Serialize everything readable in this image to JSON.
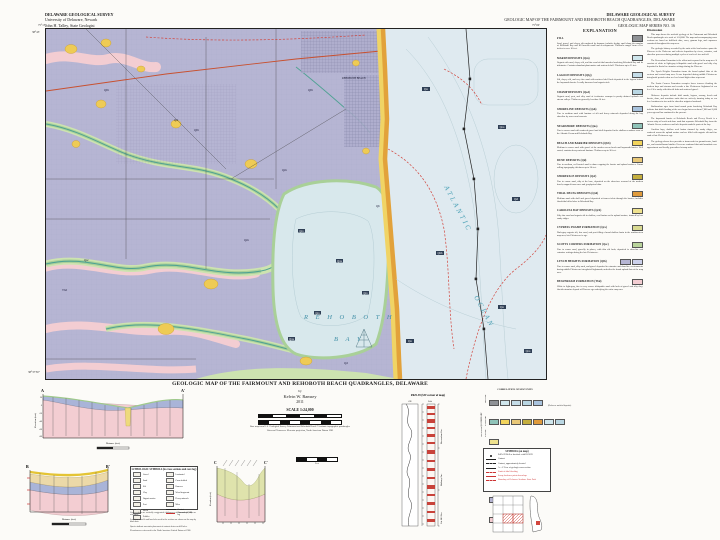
{
  "header_left": {
    "line1": "DELAWARE GEOLOGICAL SURVEY",
    "line2": "University of Delaware, Newark",
    "line3": "John H. Talley, State Geologist"
  },
  "header_right": {
    "line1": "DELAWARE GEOLOGICAL SURVEY",
    "line2": "GEOLOGIC MAP OF THE FAIRMOUNT AND REHOBOTH BEACH QUADRANGLES, DELAWARE",
    "line3": "GEOLOGIC MAP SERIES NO. 16"
  },
  "map": {
    "corner_tl": "75°15'",
    "corner_tr": "75°00'",
    "corner_lat_top": "38°45'",
    "corner_lat_bot": "38°37'30\"",
    "labels": {
      "bay1": "R E H O B O T H",
      "bay2": "B A Y",
      "ocean1": "ATLANTIC",
      "ocean2": "OCEAN",
      "town": "REHOBOTH BEACH"
    },
    "units": [
      {
        "t": "Qlh"
      },
      {
        "t": "Qlh"
      },
      {
        "t": "Qd"
      },
      {
        "t": "Qsc"
      },
      {
        "t": "Tbd"
      },
      {
        "t": "Qm"
      },
      {
        "t": "Qlh"
      },
      {
        "t": "Qb"
      },
      {
        "t": "Qd"
      },
      {
        "t": "Qm"
      }
    ],
    "samples": [
      "Qm",
      "Qns",
      "Qsf",
      "Qbb",
      "Qm",
      "Qns",
      "Qm",
      "Qm",
      "Qns",
      "Qm",
      "Qm",
      "Qns"
    ]
  },
  "legend": {
    "title": "EXPLANATION",
    "entries": [
      {
        "heading": "FILL",
        "chips": [
          "#8f9296"
        ],
        "text": "Sand, gravel, and clayey silt emplaced by humans; includes dredge spoil along the margins of Rehoboth Bay and fill beneath roads and developments. Thickness ranges from a few inches to over 10 feet."
      },
      {
        "heading": "MARSH DEPOSITS (Qm)",
        "chips": [
          "#cfe6ec"
        ],
        "text": "Organic-rich mud, clayey silt, and fine sand of tidal marshes bordering Rehoboth Bay and its tributaries. Contains abundant plant matter and scattered shell. Thickness up to 25 feet."
      },
      {
        "heading": "LAGOON DEPOSITS (Qlg)",
        "chips": [
          "#c5dde8"
        ],
        "text": "Silt, clayey silt, and very fine sand with scattered shell beds deposited in the lagoon behind the baymouth barrier. Locally burrowed and organic-rich."
      },
      {
        "heading": "SWAMP DEPOSITS (Qsd)",
        "chips": [
          "#b9d6e2"
        ],
        "text": "Organic mud, peat, and silty sand of freshwater swamps in poorly drained uplands and stream valleys. Thickness generally less than 10 feet."
      },
      {
        "heading": "SHORELINE DEPOSITS (Qsh)",
        "chips": [
          "#a9c3dd"
        ],
        "text": "Fine to medium sand with laminae of silt and heavy minerals deposited along the bay shoreline by waves and currents."
      },
      {
        "heading": "NEARSHORE DEPOSITS (Qns)",
        "chips": [
          "#8fc3b8"
        ],
        "text": "Fine to coarse sand with scattered gravel and shell deposited in the shallow nearshore zone of the Atlantic Ocean and Rehoboth Bay."
      },
      {
        "heading": "BEACH AND BARRIER DEPOSITS (Qbb)",
        "chips": [
          "#f2d45c"
        ],
        "text": "Medium to coarse sand with gravel of the modern ocean beach and baymouth barrier. Well sorted; contains heavy-mineral laminae. Thickness up to 30 feet."
      },
      {
        "heading": "DUNE DEPOSITS (Qd)",
        "chips": [
          "#e9c878"
        ],
        "text": "Fine to medium, well-sorted sand in dunes capping the barrier and upland surfaces. Forms rolling topography; thickness up to 20 feet."
      },
      {
        "heading": "SHOREFACE DEPOSITS (Qsf)",
        "chips": [
          "#c4ae3e"
        ],
        "text": "Fine to coarse sand, silty at the base, deposited on the shoreface seaward of the modern beach; mapped from cores and geophysical data."
      },
      {
        "heading": "TIDAL DELTA DEPOSITS (Qtd)",
        "chips": [
          "#e09b3c"
        ],
        "text": "Medium sand with shell and gravel deposited at former inlets through the barrier; includes flood-tidal delta lobes in Rehoboth Bay."
      },
      {
        "heading": "CAROLINA BAY DEPOSITS (Qcb)",
        "chips": [
          "#efe28e"
        ],
        "text": "Silty fine sand and organic silt in shallow, oval basins on the upland surface; rimmed by low sandy ridges."
      },
      {
        "heading": "CYPRESS SWAMP FORMATION (Qcs)",
        "chips": [
          "#d9da92"
        ],
        "text": "Dark-gray organic silt, fine sand, and peat filling a broad shallow basin in the southwestern map area; late Pleistocene in age."
      },
      {
        "heading": "SCOTTS CORNERS FORMATION (Qsc)",
        "chips": [
          "#b9d49b"
        ],
        "text": "Fine to coarse sand, gravelly in places, with thin silt beds; deposited in shoreline and estuarine settings during the late Pleistocene."
      },
      {
        "heading": "LYNCH HEIGHTS FORMATION (Qlh)",
        "chips": [
          "#b6b5d3",
          "#ccd0ea"
        ],
        "text": "Fine to coarse sand, silty sand, and gravel deposited in estuarine and shoreline environments during middle Pleistocene interglacial highstands; underlies the broad upland flats of the map area."
      },
      {
        "heading": "BEAVERDAM FORMATION (Tbd)",
        "chips": [
          "#f3cdd2"
        ],
        "text": "White to light-gray, fine to very coarse feldspathic sand with beds of gravel and silty clay; fluvial-estuarine deposit of Pliocene age underlying the entire map area."
      }
    ]
  },
  "discussion": {
    "title": "Discussion",
    "paragraphs": [
      "This map shows the surficial geology of the Fairmount and Rehoboth Beach quadrangles at a scale of 1:24,000. The map and accompanying cross sections are based on drill-hole data, cores, gamma logs, and exposures examined throughout the map area.",
      "The geologic history recorded by the units at the land surface spans the Pliocene to the Holocene and reflects deposition by rivers, estuaries, and shoreline processes during multiple cycles of sea-level rise and fall.",
      "The Beaverdam Formation is the oldest unit exposed in the map area. It consists of white to light-gray feldspathic sand with gravel and silty clay deposited in fluvial to estuarine settings during the Pliocene.",
      "The Lynch Heights Formation forms the broad upland flats of the western and central map area. It was deposited during middle Pleistocene interglacial periods when sea level stood higher than at present.",
      "The Scotts Corners Formation occupies lower terraces flanking the modern bays and streams and records a late Pleistocene highstand of sea level. It is sandy with thin silt beds and scattered gravel.",
      "Holocene deposits include tidal marsh, lagoon, swamp, beach and barrier, dune, and nearshore units that are actively forming today as sea level continues to rise and the shoreline migrates landward.",
      "Radiocarbon ages from basal marsh peats bordering Rehoboth Bay indicate that tidal flooding of the area began between about 7,000 and 5,000 years ago and has continued to the present.",
      "The baymouth barrier at Rehoboth Beach and Dewey Beach is a narrow strip of beach and dune sand that separates Rehoboth Bay from the Atlantic Ocean; washover and inlet deposits underlie parts of the bay.",
      "Carolina bays, shallow oval basins rimmed by sandy ridges, are scattered across the upland surface and are filled with organic silt and fine sand of late Pleistocene age.",
      "The geology shown here provides a framework for ground-water, land-use, and coastal-hazard studies. Users are cautioned that unit boundaries are approximate and locally generalized at map scale."
    ]
  },
  "titleblock": {
    "title": "GEOLOGIC MAP OF THE FAIRMOUNT AND REHOBOTH BEACH QUADRANGLES, DELAWARE",
    "by": "by",
    "author": "Kelvin W. Ramsey",
    "year": "2011",
    "scale": "SCALE 1:24,000",
    "note1": "Base map from U.S. Geological Survey Fairmount and Rehoboth Beach 7.5-minute topographic quadrangles",
    "note2": "Universal Transverse Mercator projection, North American Datum 1983"
  },
  "sectionA": {
    "start": "A",
    "end": "A'",
    "ylabel": "Elevation (feet)",
    "xlabel": "Distance (feet)",
    "ticks": [
      "20",
      "0",
      "-20",
      "-40",
      "-60",
      "-80"
    ]
  },
  "sectionB": {
    "start": "B",
    "end": "B'",
    "ylabel": "Elevation (feet)",
    "xlabel": "Distance (feet)"
  },
  "sectionC": {
    "start": "C",
    "end": "C'",
    "ylabel": "Elevation (feet)"
  },
  "midbar": {
    "label": "Feet"
  },
  "corelog": {
    "title": "Pd25-39 (SW corner of map)",
    "gr": "GR",
    "lith": "Lith",
    "depth": "Depth (ft)",
    "fms": [
      "Beaverdam Fm.",
      "Bethany Fm.",
      "Cat Hill Fm."
    ]
  },
  "correlation": {
    "title": "CORRELATION OF MAP UNITS",
    "row1": [
      "#8f9296",
      "#cfe6ec",
      "#c5dde8",
      "#b9d6e2",
      "#a9c3dd"
    ],
    "row1_note": "(Holocene surficial deposits)",
    "row2": [
      "#8fc3b8",
      "#f2d45c",
      "#e9c878",
      "#c4ae3e",
      "#e09b3c",
      "#cfe6ec",
      "#b9d6e2"
    ],
    "row3": [
      "#efe28e"
    ],
    "row4": [
      "#d9da92"
    ],
    "row5": [
      "#b9d49b"
    ],
    "row6": [
      "#b6b5d3",
      "#ccd0ea"
    ],
    "row7": [
      "#f3cdd2"
    ],
    "era_quaternary": "QUATERNARY",
    "epoch_holocene": "Holocene",
    "epoch_pleistocene": "Pleistocene",
    "era_neogene": "NEOGENE",
    "epoch_pliocene": "Pliocene"
  },
  "symbols": {
    "title": "SYMBOLS (on map)",
    "rows": [
      {
        "glyph": "dot",
        "label": "Pd25-39  Well or borehole with DGS ID"
      },
      {
        "glyph": "line",
        "label": "Contact"
      },
      {
        "glyph": "dash",
        "label": "Contact, approximately located"
      },
      {
        "glyph": "line",
        "label": "A—A'  Line of geologic cross section"
      },
      {
        "glyph": "reddash",
        "label": "Limit of tidal flooding"
      },
      {
        "glyph": "redline",
        "label": "Scarp; hachures point downslope"
      },
      {
        "glyph": "reddash",
        "label": "Boundary of Delaware Seashore State Park"
      }
    ]
  },
  "lith": {
    "title": "LITHOLOGIC SYMBOLS (in cross sections and core log)",
    "left": [
      "Gravel",
      "Sand",
      "Silt",
      "Clay",
      "Organic matter",
      "Peat",
      "Shells",
      "Pebbles"
    ],
    "right": [
      "Laminated",
      "Cross-bedded",
      "Burrows",
      "Wood fragments",
      "Heavy minerals",
      "Mica",
      "Contact",
      "Gamma-ray (GR) log"
    ],
    "footnotes": [
      "Cross sections are vertically exaggerated; thicknesses of thin surficial units are schematic.",
      "Locations of wells and boreholes used in the sections are shown on the map by black dots.",
      "Queries indicate uncertain placement of contacts between drill holes.",
      "Elevations are referenced to the North American Vertical Datum of 1988."
    ]
  },
  "locmap": {
    "caption": "Location of map area"
  }
}
